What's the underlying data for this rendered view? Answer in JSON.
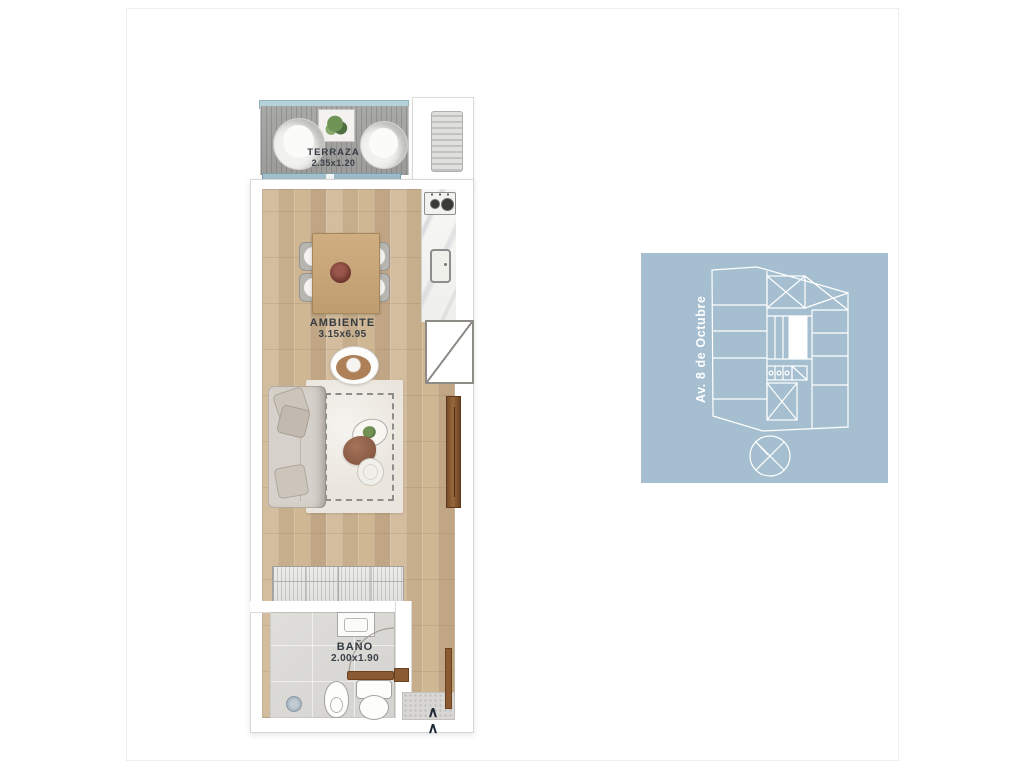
{
  "floorplan": {
    "rooms": {
      "terraza": {
        "name": "TERRAZA",
        "dims": "2.35x1.20"
      },
      "ambiente": {
        "name": "AMBIENTE",
        "dims": "3.15x6.95"
      },
      "bano": {
        "name": "BAÑO",
        "dims": "2.00x1.90"
      }
    },
    "entry_marker": "∧"
  },
  "keyplan": {
    "street_label": "Av. 8 de Octubre"
  },
  "colors": {
    "keyplan_background": "#a5bfd0",
    "keyplan_lines": "#ffffff",
    "wood_floor": "#c9b190",
    "terrace_rail": "#b5d1d9",
    "terrace_deck": "#a1a19f",
    "door_wood": "#8a5a33",
    "label_text": "#353b42"
  }
}
